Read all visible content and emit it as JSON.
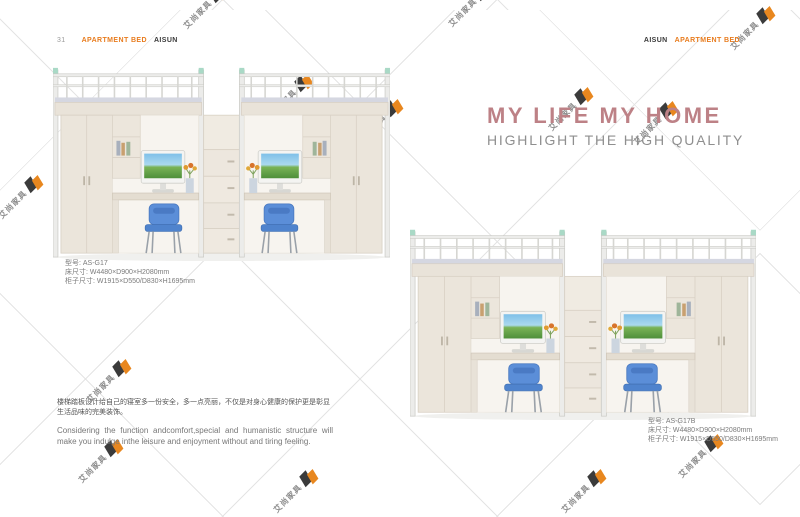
{
  "header": {
    "left": {
      "page_number": "31",
      "category": "APARTMENT BED",
      "brand": "AISUN"
    },
    "right": {
      "brand": "AISUN",
      "category": "APARTMENT BED"
    }
  },
  "headline": {
    "title": "MY LIFE MY HOME",
    "subtitle": "HIGHLIGHT THE HIGH QUALITY"
  },
  "products": [
    {
      "model": "型号: AS-G17",
      "bed_size": "床尺寸: W4480×D900×H2080mm",
      "cabinet_size": "柜子尺寸: W1915×D550/D830×H1695mm"
    },
    {
      "model": "型号: AS-G17B",
      "bed_size": "床尺寸: W4480×D900×H2080mm",
      "cabinet_size": "柜子尺寸: W1915×D550/D830×H1695mm"
    }
  ],
  "description": {
    "chinese": "楼梯踏板设计给自己的寝室多一份安全，多一点亮丽，不仅是对身心健康的保护更是彰显生活品味的完美装饰。",
    "english": "Considering the function andcomfort,special and humanistic structure will make you indulge inthe leisure and enjoyment without and tiring feeling."
  },
  "watermark": {
    "company": "艾尚家具",
    "positions": [
      [
        205,
        6
      ],
      [
        470,
        4
      ],
      [
        752,
        27
      ],
      [
        20,
        196
      ],
      [
        290,
        95
      ],
      [
        380,
        120
      ],
      [
        570,
        108
      ],
      [
        655,
        122
      ],
      [
        488,
        290
      ],
      [
        285,
        207
      ],
      [
        108,
        380
      ],
      [
        100,
        460
      ],
      [
        295,
        490
      ],
      [
        583,
        490
      ],
      [
        700,
        455
      ]
    ]
  },
  "colors": {
    "accent_orange": "#e87c1e",
    "headline_rose": "#bd8186",
    "subtitle_gray": "#8f8f8f",
    "chair_blue": "#5b8ed8",
    "wood_beige": "#ebe5db",
    "frame_mint": "#a9d9c6",
    "watermark_orange": "#e8871f"
  }
}
